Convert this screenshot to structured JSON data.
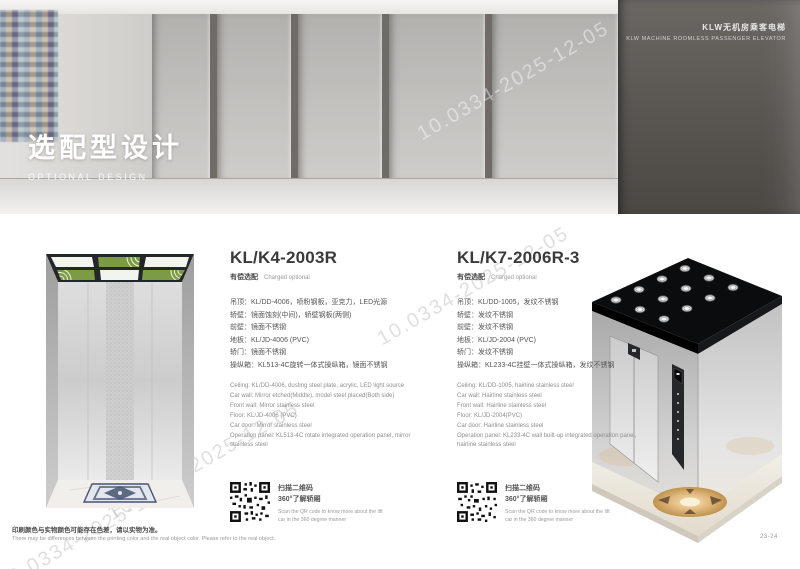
{
  "header": {
    "title_cn": "KLW无机房乘客电梯",
    "title_en": "KLW MACHINE ROOMLESS PASSENGER ELEVATOR"
  },
  "hero": {
    "title_cn": "选配型设计",
    "title_en": "OPTIONAL DESIGN"
  },
  "watermark": {
    "text": "10.0334-2025-12-05"
  },
  "products": [
    {
      "model": "KL/K4-2003R",
      "badge_cn": "有偿选配",
      "badge_en": "Charged optional",
      "specs_cn": [
        "吊顶：KL/DD-4006，喷粉钢板，亚克力，LED光源",
        "轿壁：镜面蚀刻(中间)，轿壁钢板(两侧)",
        "前壁：镜面不锈钢",
        "地板：KL/JD-4006 (PVC)",
        "轿门：镜面不锈钢",
        "操纵箱：KL513-4C旋转一体式操纵箱，镜面不锈钢"
      ],
      "specs_en": [
        "Ceiling: KL/DD-4006, dusting steel plate, acrylic, LED light source",
        "Car wall: Mirror etched(Middle), model steel placed(Both side)",
        "Front wall: Mirror stainless steel",
        "Floor: KL/JD-4006 (PVC)",
        "Car door: Mirror stainless steel",
        "Operation panel: KL513-4C rotate integrated operation panel, mirror stainless steel"
      ],
      "qr_cn1": "扫描二维码",
      "qr_cn2": "360°了解轿厢",
      "qr_en": "Scan the QR code to know more about the lift car in the 360 degree manner"
    },
    {
      "model": "KL/K7-2006R-3",
      "badge_cn": "有偿选配",
      "badge_en": "Charged optional",
      "specs_cn": [
        "吊顶：KL/DD-1005，发纹不锈钢",
        "轿壁：发纹不锈钢",
        "前壁：发纹不锈钢",
        "地板：KL/JD-2004 (PVC)",
        "轿门：发纹不锈钢",
        "操纵箱：KL233-4C挂壁一体式操纵箱，发纹不锈钢"
      ],
      "specs_en": [
        "Ceiling: KL/DD-1005, hairline stainless steel",
        "Car wall: Hairline stainless steel",
        "Front wall: Hairline stainless steel",
        "Floor: KL/JD-2004(PVC)",
        "Car door: Hairline stainless steel",
        "Operation panel: KL233-4C wall built-up integrated operation panel, hairline stainless steel"
      ],
      "qr_cn1": "扫描二维码",
      "qr_cn2": "360°了解轿厢",
      "qr_en": "Scan the QR code to know more about the lift car in the 360 degree manner"
    }
  ],
  "footer": {
    "note_cn": "印刷颜色与实物颜色可能存在色差，请以实物为准。",
    "note_en": "There may be differences between the printing color and the real object color. Please refer to the real object.",
    "page": "23-24"
  }
}
